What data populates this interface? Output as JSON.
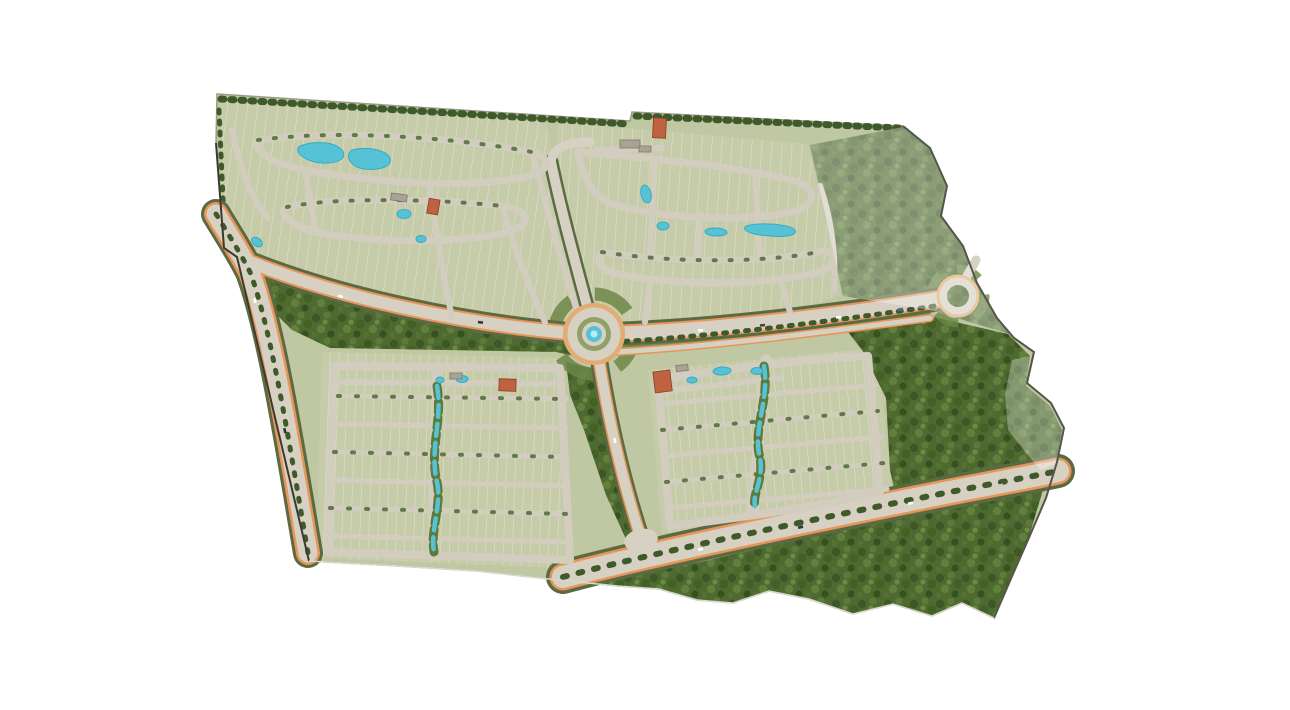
{
  "map": {
    "kind": "residential-master-plan-aerial-rendering",
    "background": "#ffffff",
    "colors": {
      "site_base": "#c0c7a3",
      "lot_field": "#c6ccaa",
      "lot_line": "#dfe3c8",
      "road": "#d7d1c3",
      "street": "#d3cdbf",
      "road_edge_orange": "#e8955a",
      "tree_row": "#3f5a2a",
      "tree_light": "#54703a",
      "verge_green": "#6d8648",
      "forest_dark": "#4f6a31",
      "water": "#56c2d6",
      "water_light": "#bfe8ef",
      "court_clay": "#c06240",
      "building_roof": "#a8a396",
      "roundabout_ring": "#e3ac70",
      "landscape_ring": "#8fa169",
      "boundary_dark": "#3a3a30",
      "boundary_soft": "#9a9a88",
      "haze": "#ffffff"
    },
    "roundabouts": [
      {
        "id": "central-roundabout",
        "center_feature": "circular-fountain-pool"
      },
      {
        "id": "east-roundabout",
        "center_feature": "tree-island"
      }
    ],
    "roads": {
      "west_boulevard": "tree-lined boulevard with orange bike lanes",
      "central_collector": "west arm to central roundabout",
      "main_avenue": "east arm between roundabouts",
      "north_arm": "road to north amenity",
      "south_arm": "road to south intersection",
      "southeast_boulevard": "divided boulevard with median trees"
    },
    "neighborhoods": [
      {
        "id": "northwest",
        "layout": "curvilinear",
        "amenities": [
          "twin-lagoon-pools",
          "clubhouse",
          "tennis-court",
          "pool"
        ]
      },
      {
        "id": "northeast",
        "layout": "curvilinear",
        "amenities": [
          "clubhouse",
          "tennis-court",
          "ponds"
        ]
      },
      {
        "id": "southwest",
        "layout": "grid",
        "amenities": [
          "linear-creek",
          "clubhouse",
          "tennis-court",
          "pools"
        ]
      },
      {
        "id": "southeast",
        "layout": "grid",
        "amenities": [
          "linear-creek",
          "clubhouse",
          "tennis-courts",
          "pools"
        ]
      }
    ],
    "forests": [
      "central-preserve",
      "east-preserve",
      "northeast-preserve-hazed",
      "south-preserve"
    ]
  }
}
